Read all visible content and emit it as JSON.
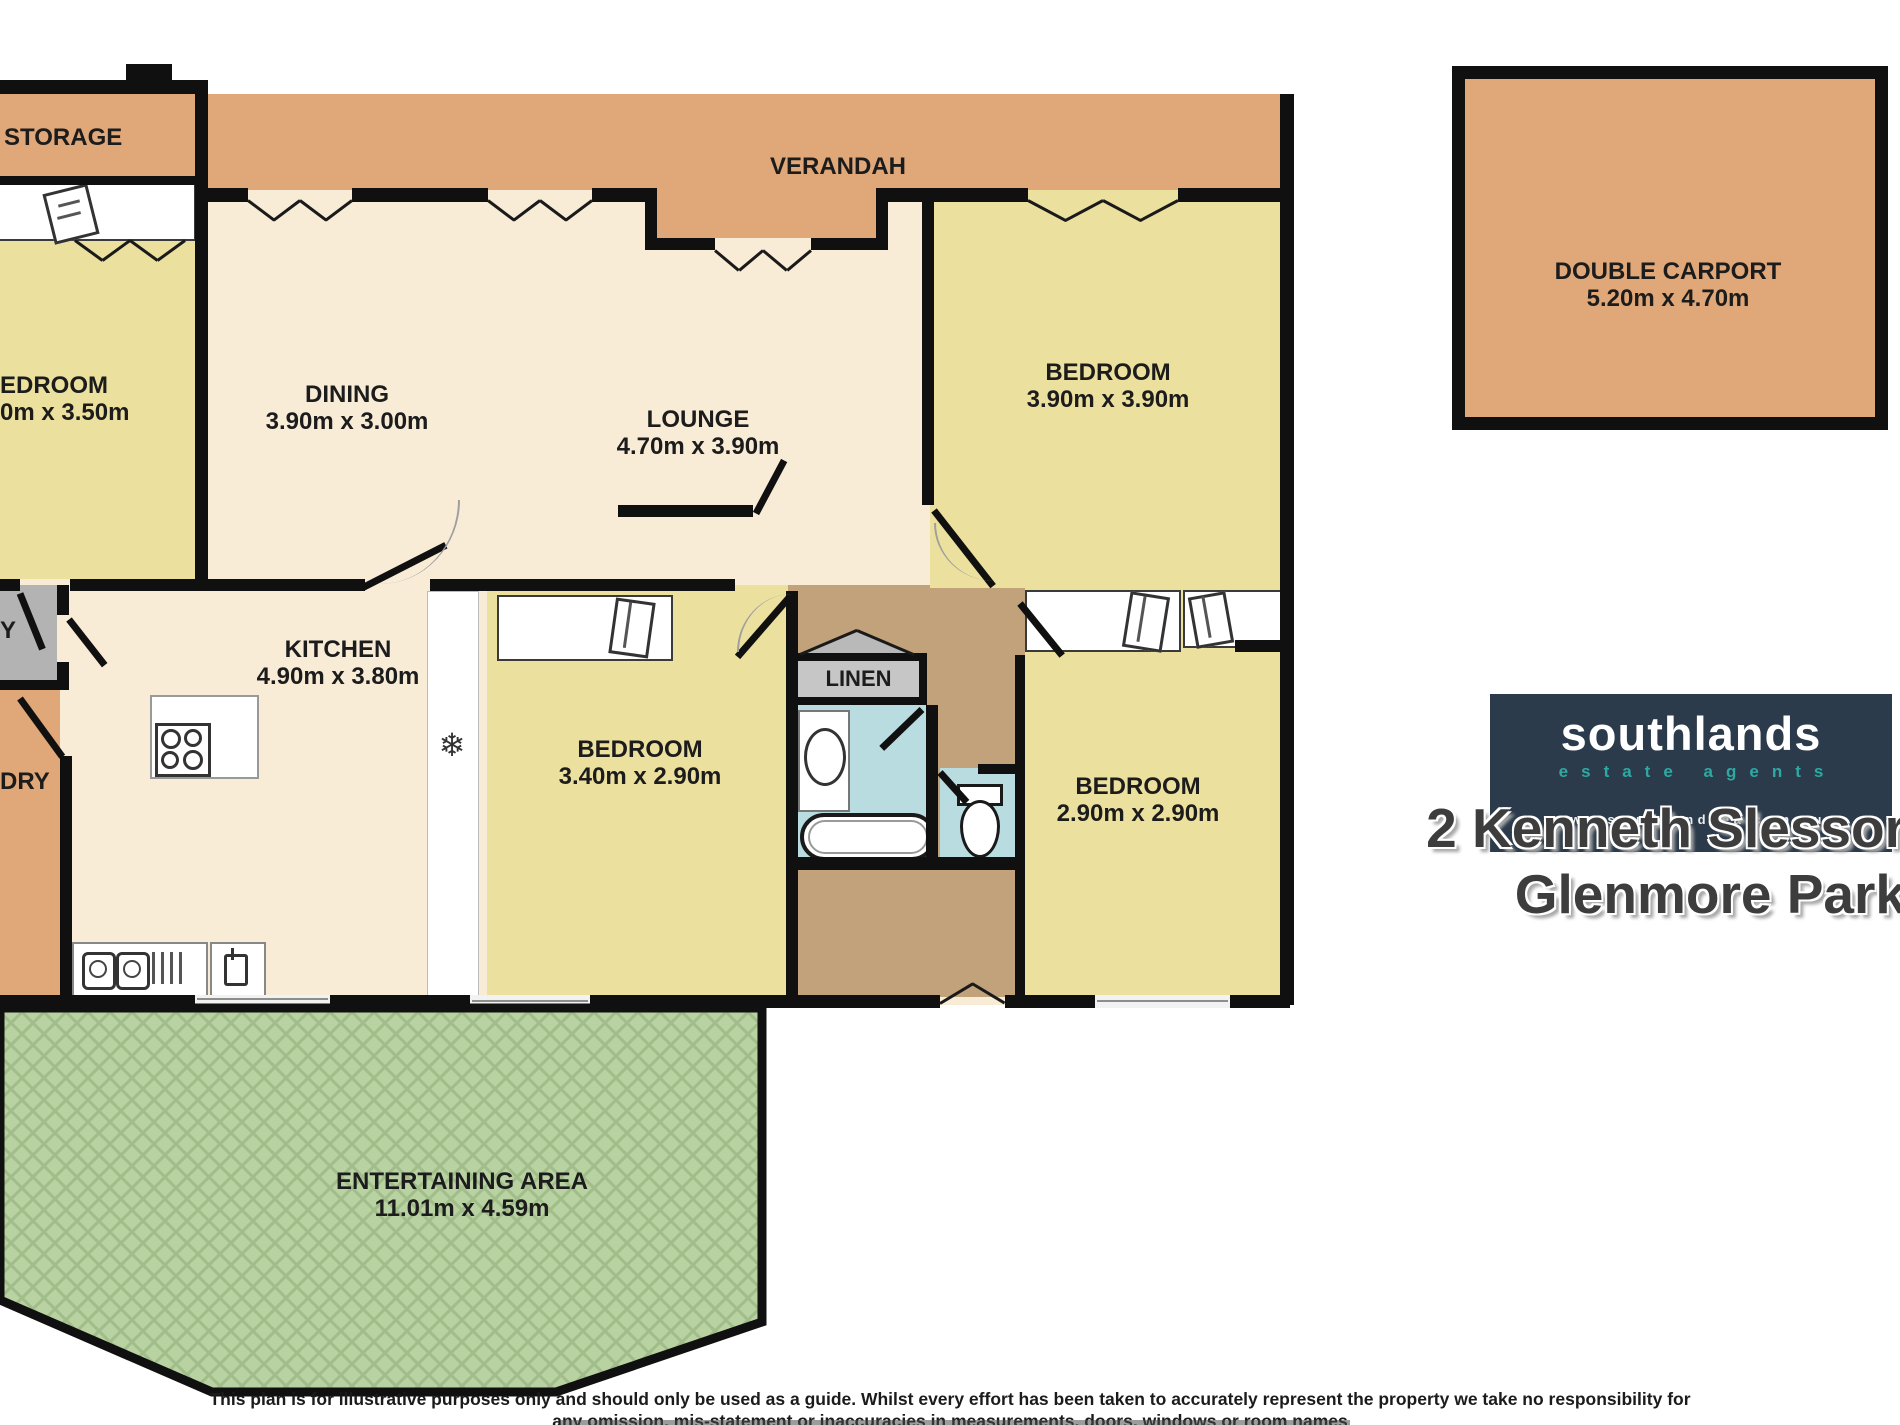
{
  "colors": {
    "wall": "#101010",
    "verandah_orange": "#e0a778",
    "living_cream": "#f8ecd6",
    "bedroom_yellow": "#ece09e",
    "entry_grey": "#b3b3b3",
    "linen_grey": "#c6c6c6",
    "hall_tan": "#c2a27b",
    "bath_blue": "#b9dce0",
    "entertaining_green": "#b9d2a2",
    "logo_navy": "#2b3b4b",
    "logo_teal": "#2fa8a2"
  },
  "plan": {
    "storage": {
      "label": "STORAGE"
    },
    "verandah": {
      "label": "VERANDAH"
    },
    "bedroom_left": {
      "label": "EDROOM",
      "dims": "0m x 3.50m"
    },
    "entry": {
      "label": "Y"
    },
    "laundry": {
      "label": "DRY"
    },
    "dining": {
      "label": "DINING",
      "dims": "3.90m x 3.00m"
    },
    "lounge": {
      "label": "LOUNGE",
      "dims": "4.70m x 3.90m"
    },
    "kitchen": {
      "label": "KITCHEN",
      "dims": "4.90m x 3.80m"
    },
    "bedroom_top_right": {
      "label": "BEDROOM",
      "dims": "3.90m x 3.90m"
    },
    "bedroom_middle": {
      "label": "BEDROOM",
      "dims": "3.40m x 2.90m"
    },
    "bedroom_bottom_right": {
      "label": "BEDROOM",
      "dims": "2.90m x 2.90m"
    },
    "linen": {
      "label": "LINEN"
    },
    "entertaining": {
      "label": "ENTERTAINING AREA",
      "dims": "11.01m x 4.59m"
    },
    "carport": {
      "label": "DOUBLE CARPORT",
      "dims": "5.20m x 4.70m"
    }
  },
  "icons": {
    "fridge_snowflake": "❄"
  },
  "logo": {
    "name": "southlands",
    "tagline": "estate agents",
    "url": "www.southlandsea.com.au"
  },
  "address": {
    "line1": "2 Kenneth Slessor",
    "line2": "Glenmore Park"
  },
  "disclaimer": {
    "line1": "This plan is for illustrative purposes only and should only be used as a guide. Whilst every effort has been taken to accurately represent the property we take no responsibility for",
    "line2": "any omission, mis-statement or inaccuracies in measurements, doors, windows or room names"
  }
}
